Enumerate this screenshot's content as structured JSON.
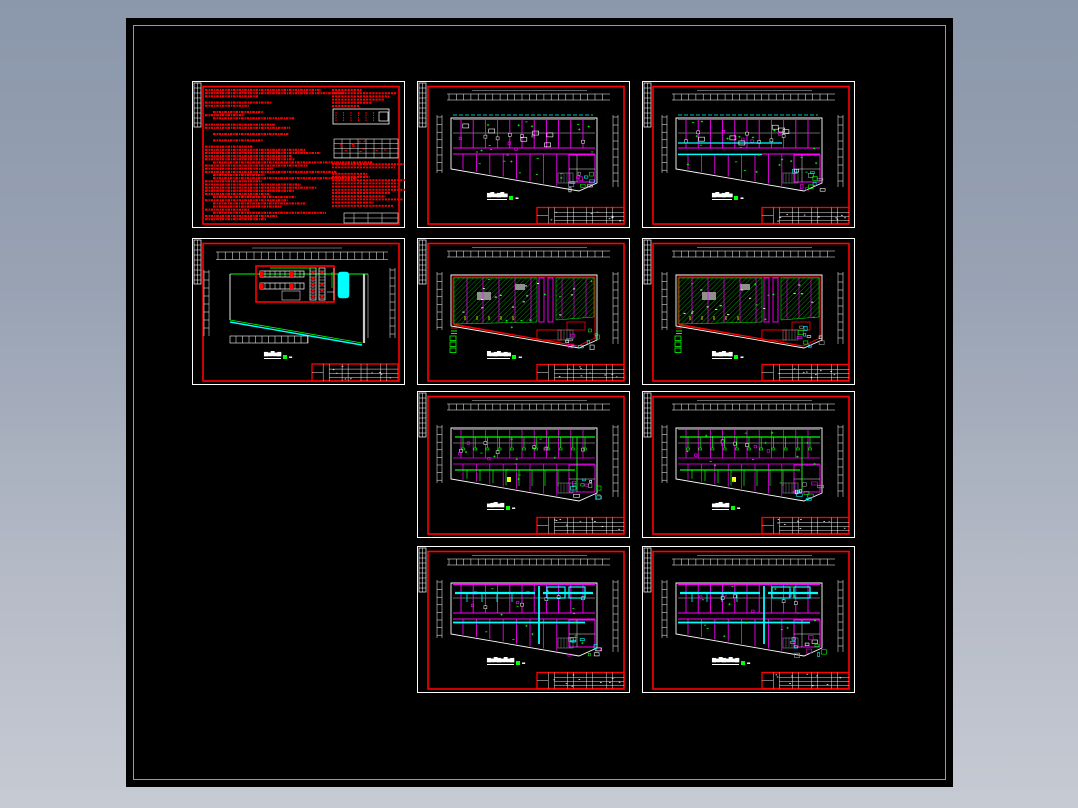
{
  "window": {
    "background_top": "#8b97ab",
    "background_bottom": "#c6cad3"
  },
  "canvas": {
    "background": "#000000",
    "border_color": "#00dcdc"
  },
  "palette": {
    "red": "#ff0000",
    "magenta": "#ff00ff",
    "green": "#00ff00",
    "cyan": "#00ffff",
    "white": "#ffffff",
    "yellow": "#ffff00",
    "gray": "#9aa0a8"
  },
  "sheets": [
    {
      "id": "design-notes",
      "type": "notes",
      "title_glyphs": "",
      "scale_glyphs": "",
      "seed": 101
    },
    {
      "id": "site-plan",
      "type": "site",
      "title_glyphs": "▆▅▇▅▆",
      "scale_glyphs": "▪▪",
      "seed": 202
    },
    {
      "id": "floor-plan-r1c2",
      "type": "magenta",
      "variant": "dash-top",
      "title_glyphs": "▆▇▅▆▇▅",
      "scale_glyphs": "▪▪",
      "seed": 303
    },
    {
      "id": "floor-plan-r1c3",
      "type": "magenta",
      "variant": "cyan-corridor",
      "title_glyphs": "▆▇▅▆▇▅",
      "scale_glyphs": "▪▪",
      "seed": 404
    },
    {
      "id": "hatch-plan-r2c2",
      "type": "hatch",
      "title_glyphs": "▇▅▆▇▅▆▅",
      "scale_glyphs": "▪▪",
      "seed": 505
    },
    {
      "id": "hatch-plan-r2c3",
      "type": "hatch",
      "title_glyphs": "▇▅▆▇▅▆",
      "scale_glyphs": "▪▪",
      "seed": 606
    },
    {
      "id": "duct-plan-r3c2",
      "type": "greenduct",
      "title_glyphs": "▅▆▇▅▆",
      "scale_glyphs": "▪▪",
      "seed": 707
    },
    {
      "id": "duct-plan-r3c3",
      "type": "greenduct",
      "title_glyphs": "▅▆▇▅▆",
      "scale_glyphs": "▪▪",
      "seed": 808
    },
    {
      "id": "vent-plan-r4c2",
      "type": "cyanduct",
      "title_glyphs": "▆▅▇▆▅▇▅▆",
      "scale_glyphs": "▪▪",
      "seed": 909
    },
    {
      "id": "vent-plan-r4c3",
      "type": "cyanduct",
      "title_glyphs": "▆▅▇▆▅▇▅▆",
      "scale_glyphs": "▪▪",
      "seed": 1010
    }
  ]
}
